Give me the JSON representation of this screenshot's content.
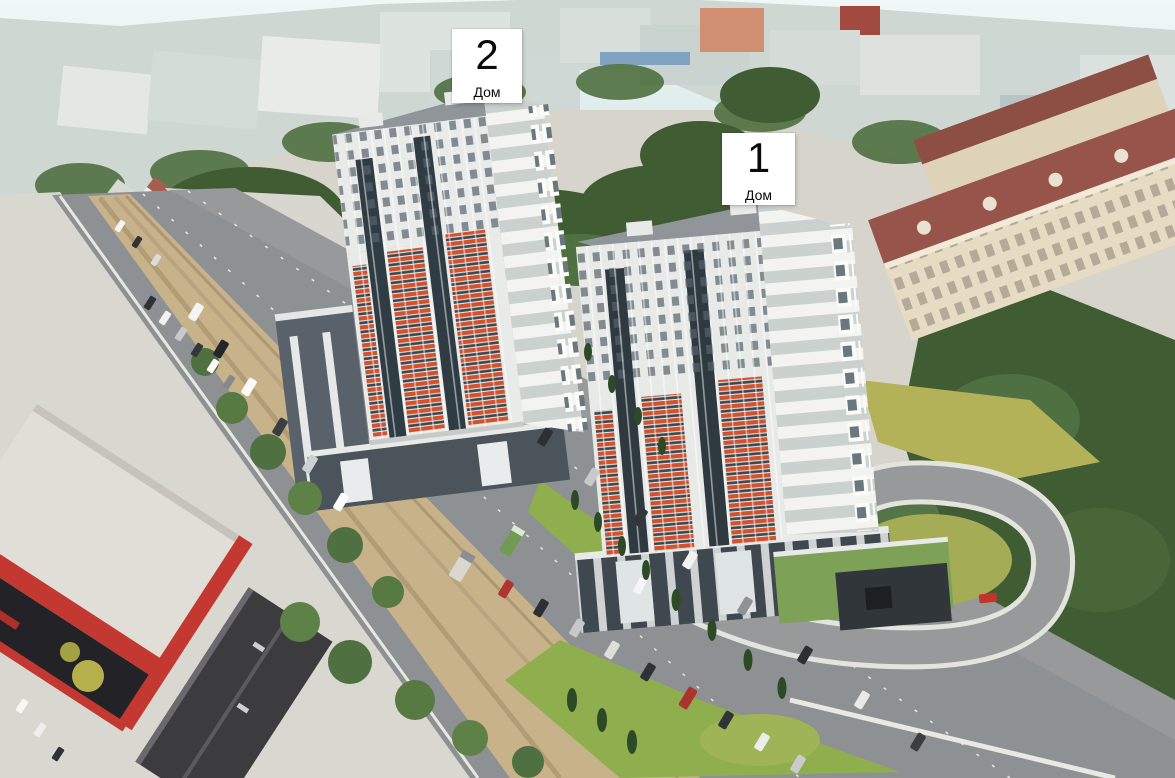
{
  "labels": [
    {
      "number": "2",
      "caption": "Дом"
    },
    {
      "number": "1",
      "caption": "Дом"
    }
  ],
  "palette": {
    "sky": "#e6f2f1",
    "city_band": "#d3dad6",
    "tree_dark": "#3f5c33",
    "tree_mid": "#4f7040",
    "lawn_green": "#8fae4d",
    "lawn_yellow": "#b3b259",
    "dirt_median": "#c8b28a",
    "asphalt": "#8e9193",
    "concrete": "#d8d7cf",
    "facade_white": "#eceeec",
    "facade_orange": "#d4522c",
    "glazing_dark": "#303c44",
    "podium_dark": "#4b545b",
    "red_building": "#c33931",
    "dark_roof_building": "#3c3c3f",
    "classic_beige": "#e6dcc3",
    "classic_roof": "#96544a",
    "roof_gray": "#93999c"
  }
}
